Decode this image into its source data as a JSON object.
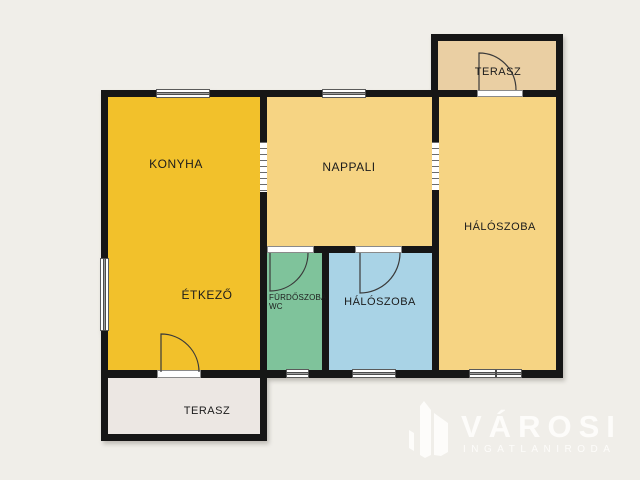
{
  "floorplan": {
    "background_color": "#F0EEE9",
    "wall_color": "#161616",
    "rooms": [
      {
        "name": "konyha",
        "label": "KONYHA",
        "color": "#F2C12B"
      },
      {
        "name": "etkezo",
        "label": "ÉTKEZŐ",
        "color": "#F2C12B"
      },
      {
        "name": "nappali",
        "label": "NAPPALI",
        "color": "#F6D483"
      },
      {
        "name": "terasz-felso",
        "label": "TERASZ",
        "color": "#EACFA3"
      },
      {
        "name": "haloszoba-nagy",
        "label": "HÁLÓSZOBA",
        "color": "#F6D483"
      },
      {
        "name": "furdoszoba-wc",
        "label": "FÜRDŐSZOBA",
        "label_line2": "WC",
        "color": "#7FC39B"
      },
      {
        "name": "haloszoba-kis",
        "label": "HÁLÓSZOBA",
        "color": "#A9D3E6"
      },
      {
        "name": "terasz-also",
        "label": "TERASZ",
        "color": "#ECE7E3"
      }
    ]
  },
  "logo": {
    "brand": "VÁROSI",
    "tagline": "INGATLANIRODA",
    "color": "#FDFCFA"
  }
}
